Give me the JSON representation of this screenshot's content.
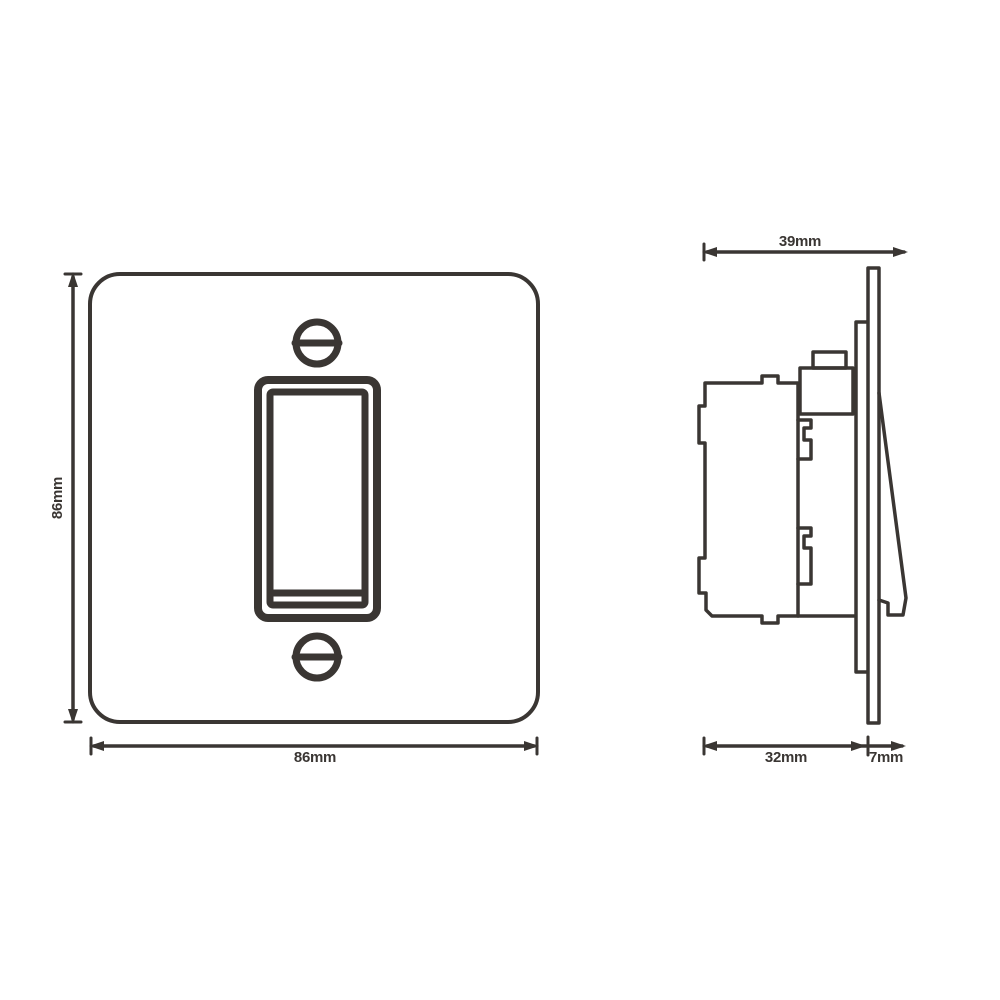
{
  "drawing": {
    "front_view": {
      "height_label": "86mm",
      "width_label": "86mm"
    },
    "side_view": {
      "overall_depth_label": "39mm",
      "body_depth_label": "32mm",
      "plate_projection_label": "7mm"
    }
  },
  "colors": {
    "line": "#3a3633",
    "background": "#ffffff"
  }
}
